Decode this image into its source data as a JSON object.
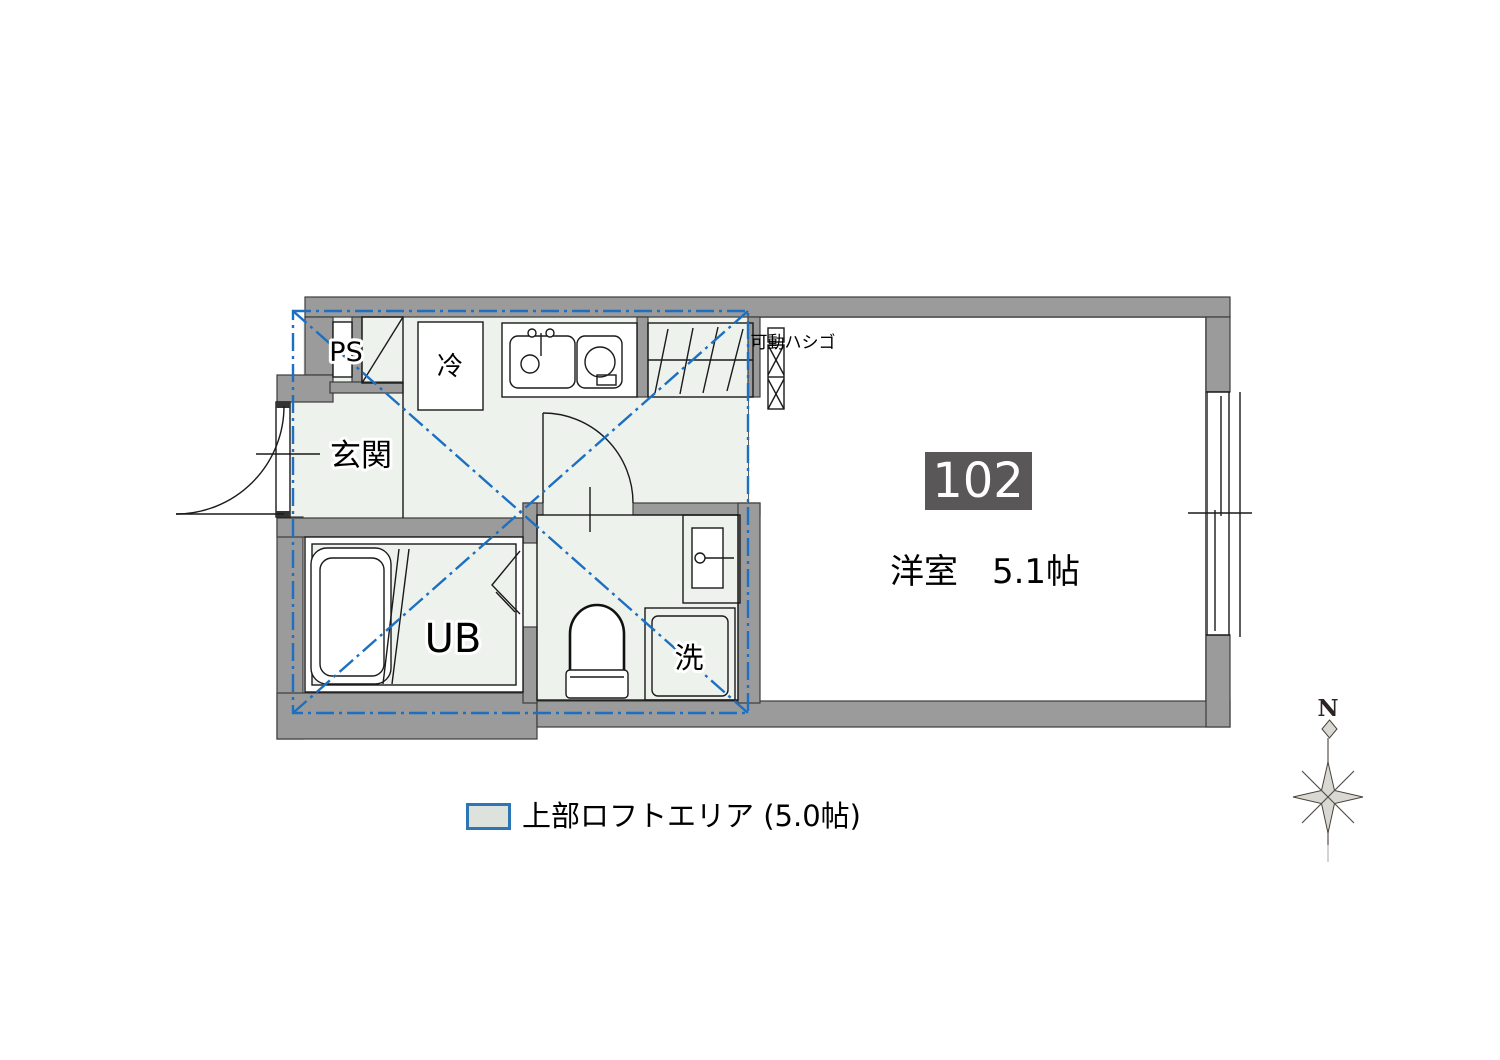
{
  "floorplan": {
    "unit_badge": "102",
    "labels": {
      "ps": "PS",
      "fridge": "冷",
      "entrance": "玄関",
      "unit_bath": "UB",
      "washer": "洗",
      "main_room": "洋室　5.1帖",
      "ladder": "可動ハシゴ"
    },
    "legend": {
      "loft_area": "上部ロフトエリア (5.0帖)"
    },
    "compass": {
      "north": "N"
    },
    "colors": {
      "wall": "#9b9b9b",
      "loft_floor": "#edf2ed",
      "loft_line": "#1d70c1",
      "badge_bg": "#595757",
      "badge_text": "#ffffff",
      "legend_swatch_border": "#2e75b6",
      "legend_swatch_fill": "#dde2dd"
    }
  }
}
